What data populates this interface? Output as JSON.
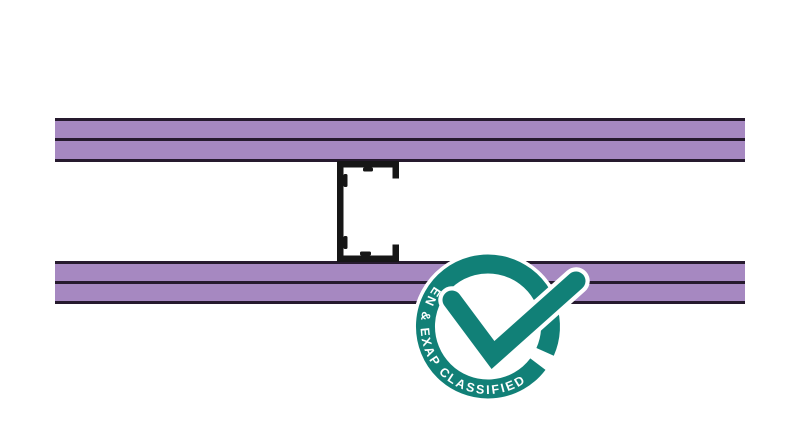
{
  "badge": {
    "label": "EN & EXAP CLASSIFIED",
    "icon": "checkmark-icon"
  },
  "diagram": {
    "top_board_layers": 2,
    "bottom_board_layers": 2,
    "stud_type": "C-stud"
  },
  "colors": {
    "background": "#ffffff",
    "board_fill": "#a688c1",
    "board_edge": "#261a2e",
    "stud": "#161616",
    "badge_teal": "#118077",
    "badge_halo": "#ffffff",
    "badge_text": "#ffffff"
  }
}
